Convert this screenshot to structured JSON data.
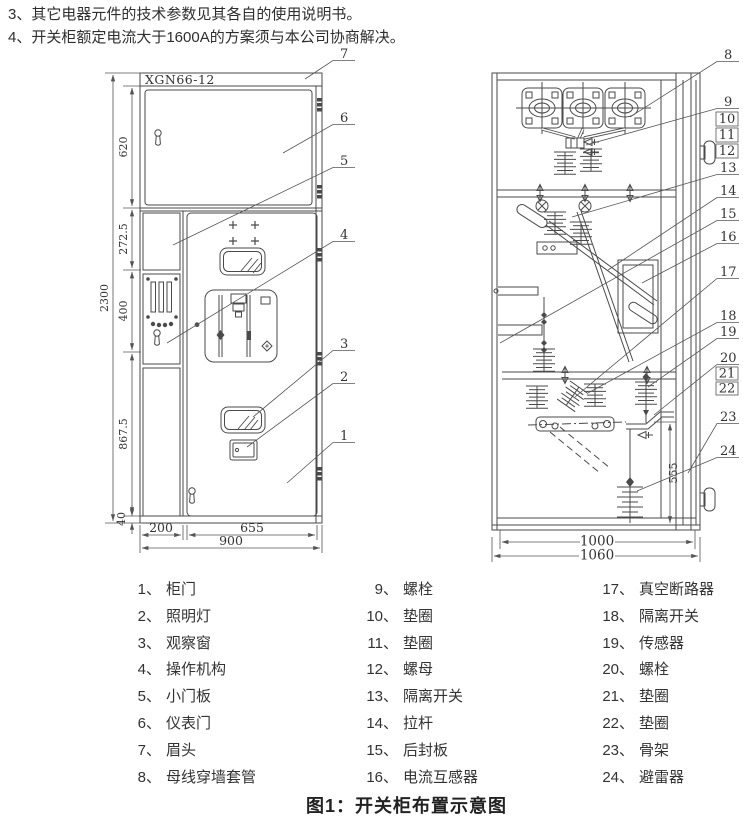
{
  "notes": [
    "3、其它电器元件的技术参数见其各自的使用说明书。",
    "4、开关柜额定电流大于1600A的方案须与本公司协商解决。"
  ],
  "figure": {
    "model": "XGN66-12",
    "callouts": [
      "1",
      "2",
      "3",
      "4",
      "5",
      "6",
      "7",
      "8",
      "9",
      "10",
      "11",
      "12",
      "13",
      "14",
      "15",
      "16",
      "17",
      "18",
      "19",
      "20",
      "21",
      "22",
      "23",
      "24"
    ],
    "front": {
      "dims": {
        "total_h": "2300",
        "sec1": "620",
        "sec2": "272.5",
        "sec3": "400",
        "sec4": "867.5",
        "sec5": "40",
        "left_w": "200",
        "door_w": "655",
        "total_w": "900"
      }
    },
    "side": {
      "dims": {
        "drop": "555",
        "inner_w": "1000",
        "total_w": "1060"
      }
    }
  },
  "legend": {
    "col1": [
      {
        "num": "1、",
        "label": "柜门"
      },
      {
        "num": "2、",
        "label": "照明灯"
      },
      {
        "num": "3、",
        "label": "观察窗"
      },
      {
        "num": "4、",
        "label": "操作机构"
      },
      {
        "num": "5、",
        "label": "小门板"
      },
      {
        "num": "6、",
        "label": "仪表门"
      },
      {
        "num": "7、",
        "label": "眉头"
      },
      {
        "num": "8、",
        "label": "母线穿墙套管"
      }
    ],
    "col2": [
      {
        "num": "9、",
        "label": "螺栓"
      },
      {
        "num": "10、",
        "label": "垫圈"
      },
      {
        "num": "11、",
        "label": "垫圈"
      },
      {
        "num": "12、",
        "label": "螺母"
      },
      {
        "num": "13、",
        "label": "隔离开关"
      },
      {
        "num": "14、",
        "label": "拉杆"
      },
      {
        "num": "15、",
        "label": "后封板"
      },
      {
        "num": "16、",
        "label": "电流互感器"
      }
    ],
    "col3": [
      {
        "num": "17、",
        "label": "真空断路器"
      },
      {
        "num": "18、",
        "label": "隔离开关"
      },
      {
        "num": "19、",
        "label": "传感器"
      },
      {
        "num": "20、",
        "label": "螺栓"
      },
      {
        "num": "21、",
        "label": "垫圈"
      },
      {
        "num": "22、",
        "label": "垫圈"
      },
      {
        "num": "23、",
        "label": "骨架"
      },
      {
        "num": "24、",
        "label": "避雷器"
      }
    ]
  },
  "caption": "图1：开关柜布置示意图"
}
